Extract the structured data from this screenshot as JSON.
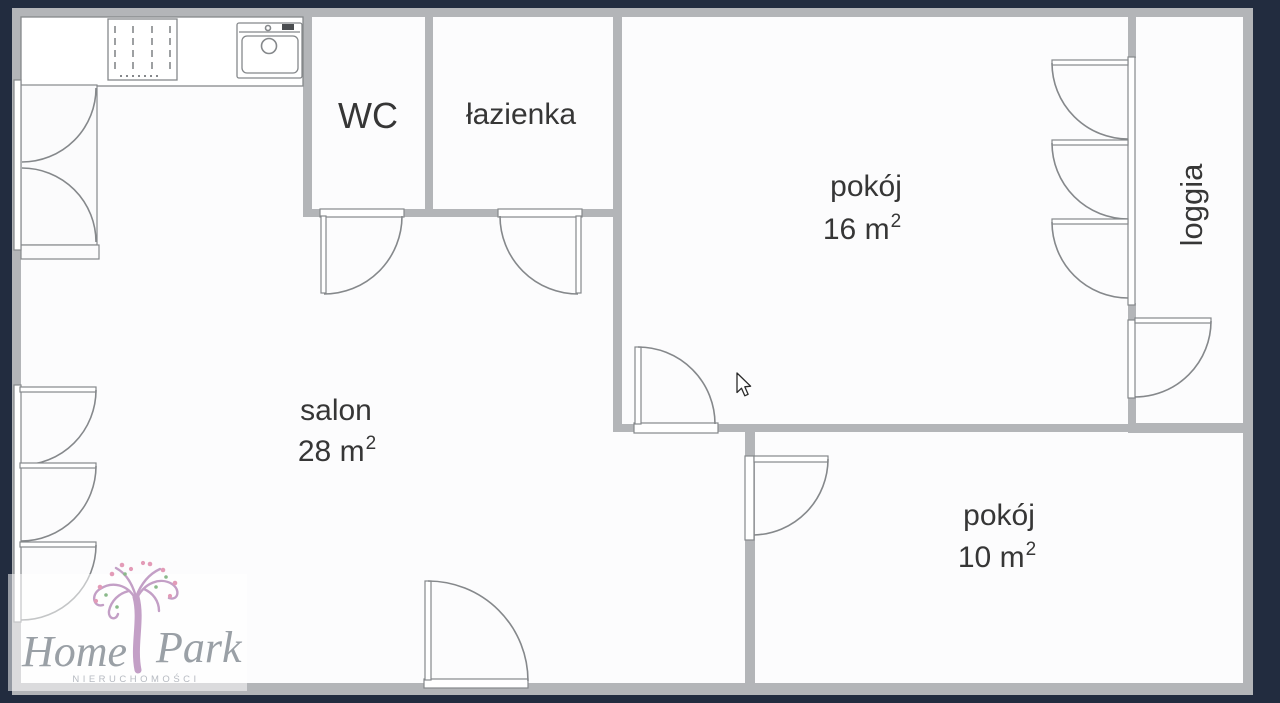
{
  "floorplan": {
    "rooms": [
      {
        "name": "wc",
        "label": "WC"
      },
      {
        "name": "bathroom",
        "label": "łazienka"
      },
      {
        "name": "room-16",
        "label": "pokój",
        "area_base": "16 m",
        "area_sup": "2"
      },
      {
        "name": "living-room",
        "label": "salon",
        "area_base": "28 m",
        "area_sup": "2"
      },
      {
        "name": "room-10",
        "label": "pokój",
        "area_base": "10 m",
        "area_sup": "2"
      },
      {
        "name": "loggia",
        "label": "loggia"
      }
    ]
  },
  "logo": {
    "word1": "Home",
    "word2": "Park",
    "subtitle": "NIERUCHOMOŚCI"
  },
  "colors": {
    "background": "#222c3f",
    "wall": "#b3b5b8",
    "line": "#85888b",
    "floor": "#fcfcfd",
    "ink": "#363636",
    "logo-ink": "#9aa0a6",
    "logo-sub": "#b6bac1",
    "trunk": "#c39fc6",
    "flower": "#e39bb7",
    "leaf": "#8ab98a"
  }
}
